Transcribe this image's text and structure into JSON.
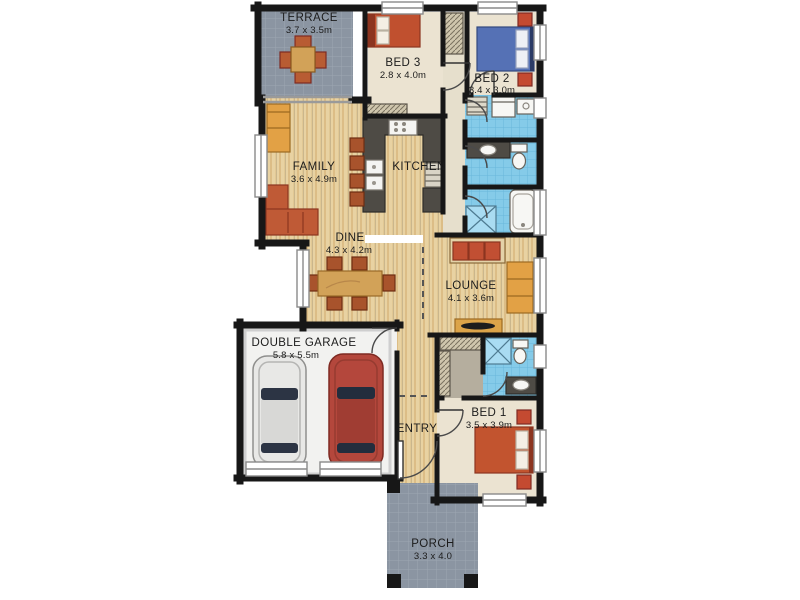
{
  "plan": {
    "rooms": {
      "terrace": {
        "name": "TERRACE",
        "dims": "3.7 x 3.5m"
      },
      "bed3": {
        "name": "BED 3",
        "dims": "2.8 x 4.0m"
      },
      "bed2": {
        "name": "BED 2",
        "dims": "3.4 x 3.0m"
      },
      "family": {
        "name": "FAMILY",
        "dims": "3.6 x 4.9m"
      },
      "kitchen": {
        "name": "KITCHEN"
      },
      "dine": {
        "name": "DINE",
        "dims": "4.3 x 4.2m"
      },
      "lounge": {
        "name": "LOUNGE",
        "dims": "4.1 x 3.6m"
      },
      "garage": {
        "name": "DOUBLE GARAGE",
        "dims": "5.8 x 5.5m"
      },
      "entry": {
        "name": "ENTRY"
      },
      "bed1": {
        "name": "BED 1",
        "dims": "3.5 x 3.9m"
      },
      "porch": {
        "name": "PORCH",
        "dims": "3.3 x 4.0"
      }
    },
    "colors": {
      "wall": "#1a1a1a",
      "wood_floor": "#e8d2a2",
      "carpet": "#ebe3d1",
      "bathroom_tile": "#85cbe9",
      "outdoor_tile": "#8b95a2",
      "garage_floor": "#f2f2f0",
      "kitchen_bench": "#4e4b45",
      "sofa_red": "#c0552f",
      "sofa_orange": "#e2a145",
      "bed_blue": "#5571b5",
      "timber": "#d2a258"
    }
  }
}
